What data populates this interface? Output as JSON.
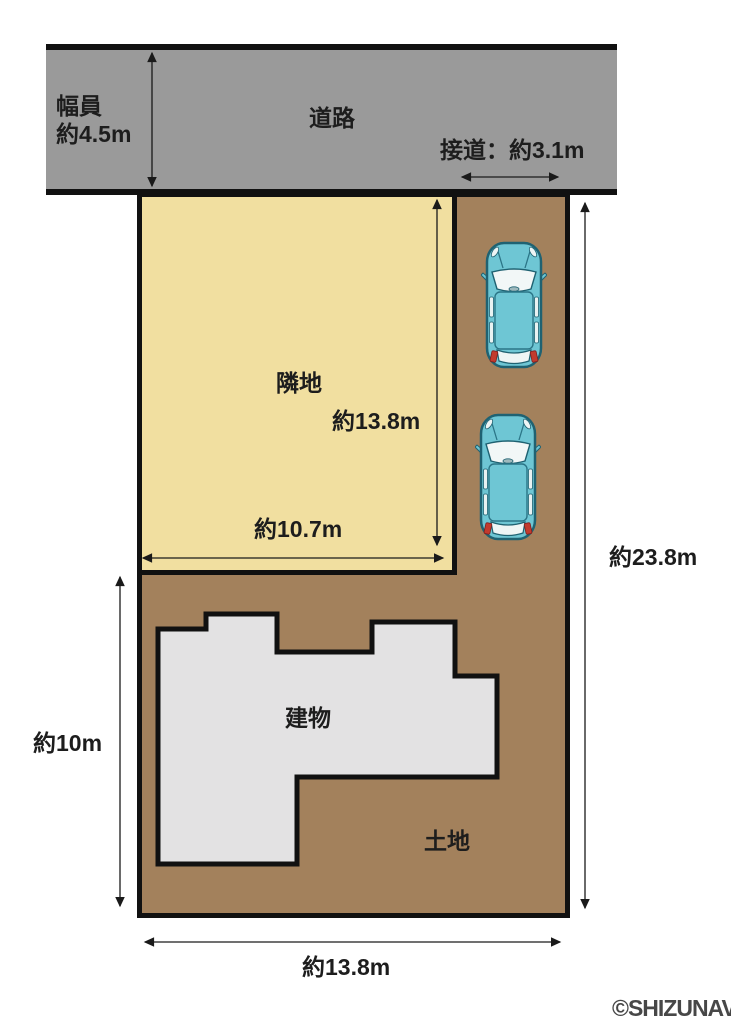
{
  "road": {
    "label": "道路",
    "width_label": {
      "line1": "幅員",
      "line2": "約4.5m"
    },
    "frontage_label": "接道：約3.1m"
  },
  "neighbor": {
    "label": "隣地",
    "depth_dim": "約13.8m",
    "width_dim": "約10.7m"
  },
  "land": {
    "label": "土地",
    "building_label": "建物",
    "right_dim": "約23.8m",
    "left_dim": "約10m",
    "bottom_dim": "約13.8m"
  },
  "vehicles": {
    "count": 2,
    "icon": "car-top-view-icon"
  },
  "watermark": "©SHIZUNAVI",
  "colors": {
    "road": "#9a9a9a",
    "neighbor": "#f1dfa0",
    "land": "#a3815c",
    "building": "#e3e2e3",
    "outline": "#111111",
    "car_body": "#6ec6d4",
    "car_outline": "#1f6272",
    "taillight": "#c23b2e",
    "text": "#1d1d1d",
    "watermark": "#474747"
  }
}
